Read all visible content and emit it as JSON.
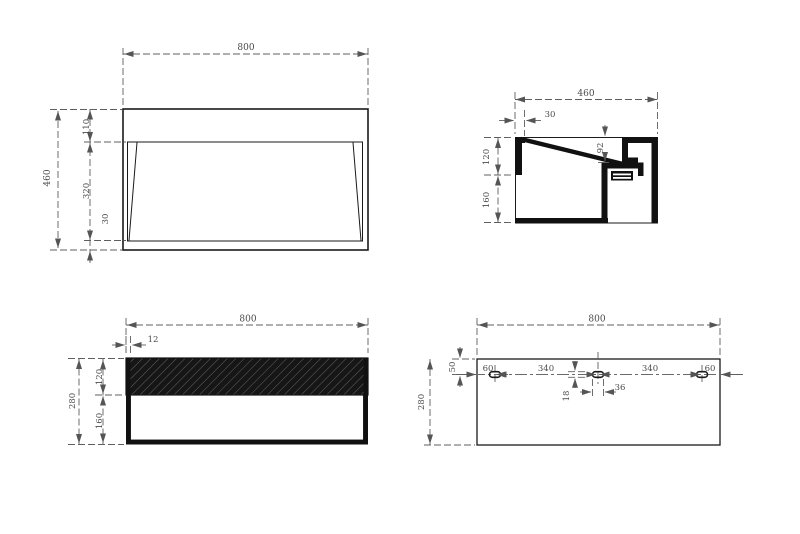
{
  "views": {
    "plan": {
      "overall_width": "800",
      "overall_depth": "460",
      "deck_depth": "110",
      "bowl_opening_depth": "320",
      "front_rim": "30"
    },
    "side_section": {
      "overall_depth": "460",
      "rim_thickness": "30",
      "upper_height": "120",
      "lower_height": "160",
      "drain_drop": "92"
    },
    "front_section": {
      "overall_width": "800",
      "wall_thickness": "12",
      "overall_height": "280",
      "upper_height": "120",
      "lower_height": "160"
    },
    "back_view": {
      "overall_width": "800",
      "slot_offset_top": "50",
      "overall_height": "280",
      "edge_to_slot_left": "60",
      "slot_pitch_left": "340",
      "slot_pitch_right": "340",
      "edge_to_slot_right": "60",
      "slot_height": "18",
      "slot_width": "36"
    }
  }
}
